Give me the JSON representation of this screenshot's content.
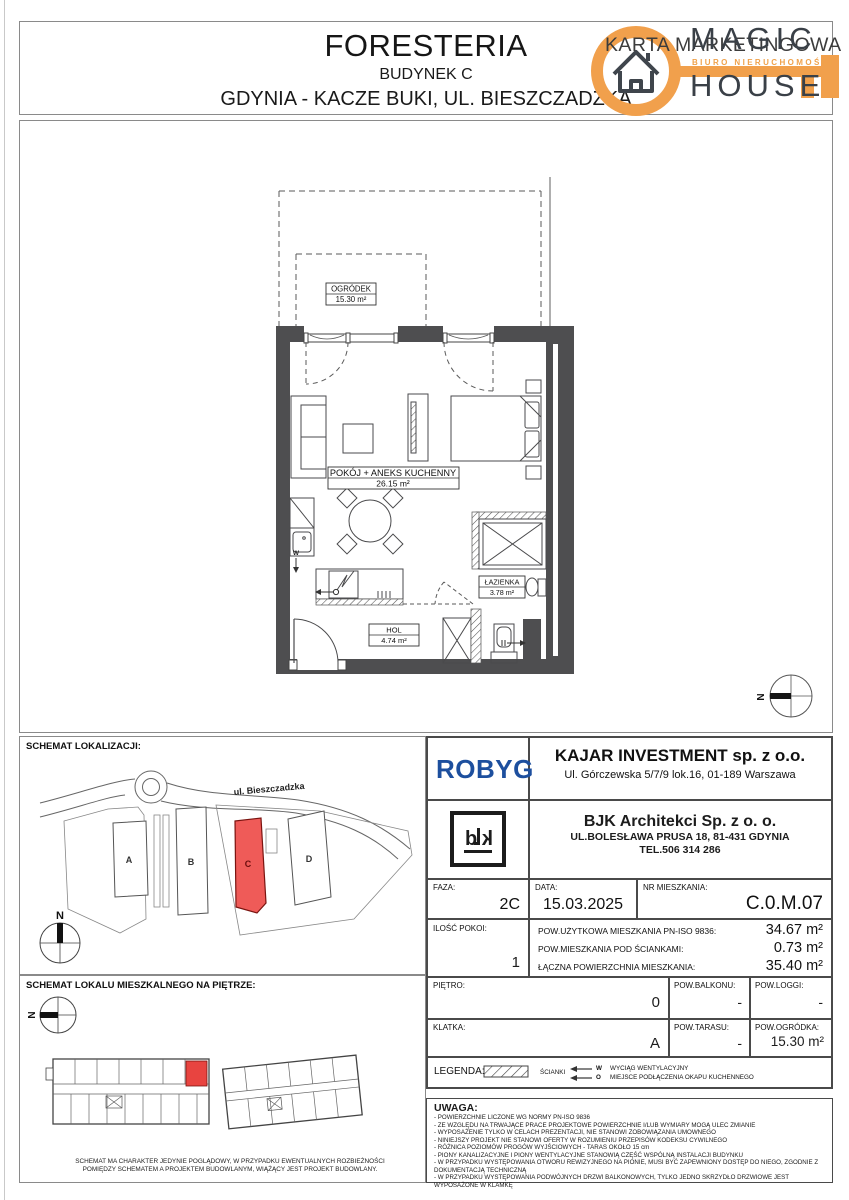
{
  "header": {
    "project": "FORESTERIA",
    "building": "BUDYNEK C",
    "location": "GDYNIA - KACZE BUKI, UL. BIESZCZADZKA",
    "card_type": "KARTA MARKETINGOWA",
    "logo": {
      "line1": "MAGIC",
      "line2": "HOUSE",
      "tagline": "BIURO NIERUCHOMOŚCI"
    }
  },
  "plan": {
    "rooms": [
      {
        "name": "OGRÓDEK",
        "area": "15.30 m²"
      },
      {
        "name": "POKÓJ + ANEKS KUCHENNY",
        "area": "26.15 m²"
      },
      {
        "name": "ŁAZIENKA",
        "area": "3.78 m²"
      },
      {
        "name": "HOL",
        "area": "4.74 m²"
      }
    ],
    "markers": {
      "vent": "W",
      "hood": "O"
    },
    "compass": "N"
  },
  "location_schematic": {
    "title": "SCHEMAT LOKALIZACJI:",
    "street": "ul. Bieszczadzka",
    "buildings": [
      "A",
      "B",
      "C",
      "D"
    ],
    "highlighted": "C",
    "compass": "N"
  },
  "floor_schematic": {
    "title": "SCHEMAT LOKALU MIESZKALNEGO NA PIĘTRZE:",
    "compass": "N",
    "disclaimer": "SCHEMAT MA CHARAKTER JEDYNIE POGLĄDOWY, W PRZYPADKU EWENTUALNYCH ROZBIEŻNOŚCI POMIĘDZY SCHEMATEM A PROJEKTEM BUDOWLANYM, WIĄŻĄCY JEST PROJEKT BUDOWLANY."
  },
  "info_table": {
    "developer_logo": "ROBYG",
    "investor": {
      "name": "KAJAR INVESTMENT sp. z o.o.",
      "address": "Ul. Górczewska 5/7/9 lok.16, 01-189 Warszawa"
    },
    "architect": {
      "name": "BJK Architekci Sp. z o. o.",
      "address": "UL.BOLESŁAWA PRUSA 18, 81-431 GDYNIA",
      "phone": "TEL.506 314 286"
    },
    "faza": {
      "label": "FAZA:",
      "value": "2C"
    },
    "data": {
      "label": "DATA:",
      "value": "15.03.2025"
    },
    "nr": {
      "label": "NR MIESZKANIA:",
      "value": "C.0.M.07"
    },
    "rooms": {
      "label": "ILOŚĆ POKOI:",
      "value": "1"
    },
    "areas": [
      {
        "label": "POW.UŻYTKOWA MIESZKANIA PN-ISO 9836:",
        "value": "34.67 m²"
      },
      {
        "label": "POW.MIESZKANIA POD ŚCIANKAMI:",
        "value": "0.73 m²"
      },
      {
        "label": "ŁĄCZNA POWIERZCHNIA MIESZKANIA:",
        "value": "35.40 m²"
      }
    ],
    "pietro": {
      "label": "PIĘTRO:",
      "value": "0"
    },
    "balkon": {
      "label": "POW.BALKONU:",
      "value": "-"
    },
    "loggia": {
      "label": "POW.LOGGI:",
      "value": "-"
    },
    "klatka": {
      "label": "KLATKA:",
      "value": "A"
    },
    "taras": {
      "label": "POW.TARASU:",
      "value": "-"
    },
    "ogrodek": {
      "label": "POW.OGRÓDKA:",
      "value": "15.30 m²"
    }
  },
  "legend": {
    "title": "LEGENDA:",
    "walls_label": "ŚCIANKI",
    "vent_letter": "W",
    "vent_label": "WYCIĄG WENTYLACYJNY",
    "hood_letter": "O",
    "hood_label": "MIEJSCE PODŁĄCZENIA OKAPU KUCHENNEGO"
  },
  "uwaga": {
    "title": "UWAGA:",
    "notes": [
      "- POWIERZCHNIE LICZONE WG NORMY PN-ISO 9836",
      "- ZE WZGLĘDU NA TRWAJĄCE PRACE PROJEKTOWE POWIERZCHNIE I/LUB WYMIARY MOGĄ ULEC ZMIANIE",
      "- WYPOSAŻENIE TYLKO W CELACH PREZENTACJI, NIE STANOWI ZOBOWIĄZANIA UMOWNEGO",
      "- NINIEJSZY PROJEKT NIE STANOWI OFERTY W ROZUMIENIU PRZEPISÓW KODEKSU CYWILNEGO",
      "- RÓŻNICA POZIOMÓW PROGÓW WYJŚCIOWYCH - TARAS OKOŁO 15 cm",
      "- PIONY KANALIZACYJNE I PIONY WENTYLACYJNE STANOWIĄ CZĘŚĆ WSPÓLNĄ INSTALACJI BUDYNKU",
      "- W PRZYPADKU WYSTĘPOWANIA OTWORU REWIZYJNEGO NA PIONIE, MUSI BYĆ ZAPEWNIONY DOSTĘP DO NIEGO, ZGODNIE Z DOKUMENTACJĄ TECHNICZNĄ",
      "- W PRZYPADKU WYSTĘPOWANIA PODWÓJNYCH DRZWI BALKONOWYCH, TYLKO JEDNO SKRZYDŁO DRZWIOWE JEST WYPOSAŻONE W KLAMKĘ"
    ]
  }
}
